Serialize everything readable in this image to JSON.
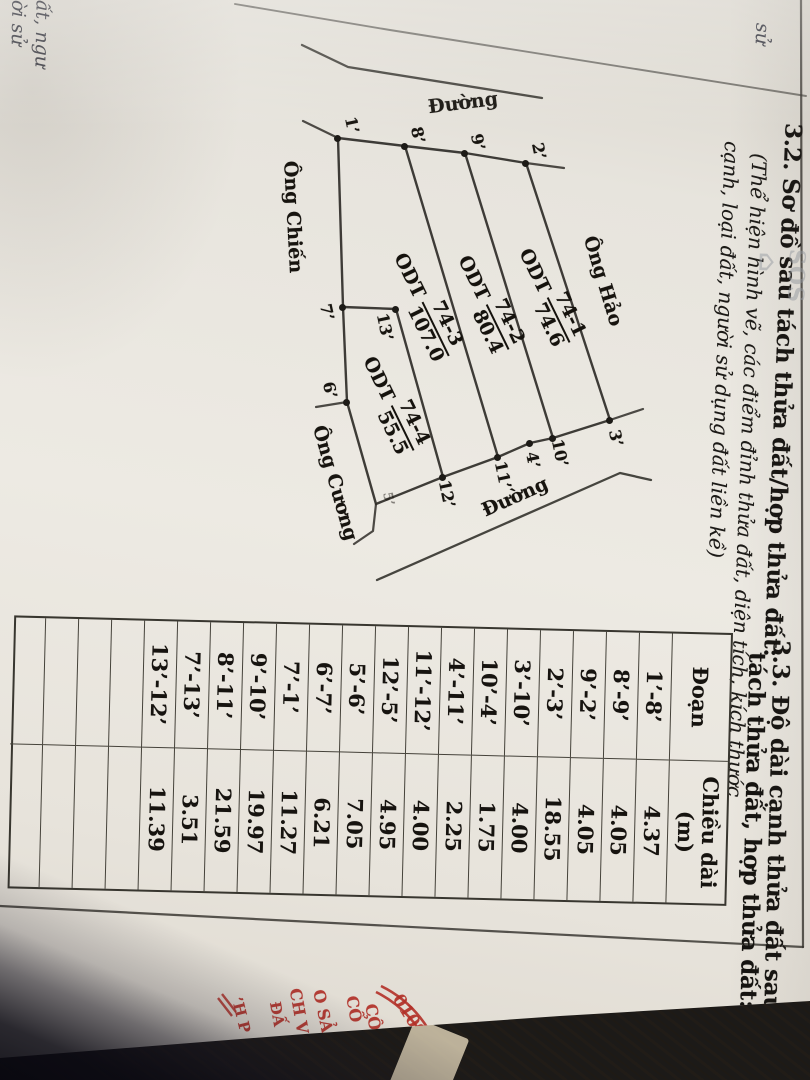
{
  "section_32": {
    "title": "3.2. Sơ đồ sau tách thửa đất/hợp thửa đất:",
    "subtitle_line1": "(Thể hiện hình vẽ, các điểm đỉnh thửa đất, diện tích, kích thước",
    "subtitle_line2": "cạnh, loại đất, người sử dụng đất liền kề)"
  },
  "section_33": {
    "title_line1": "3.3. Độ dài cạnh thửa đất sau",
    "title_line2": "tách thửa đất, hợp thửa đất:"
  },
  "table": {
    "col1_header": "Đoạn",
    "col2_header_line1": "Chiều dài",
    "col2_header_line2": "(m)",
    "rows": [
      {
        "segment": "1’-8’",
        "length": "4.37"
      },
      {
        "segment": "8’-9’",
        "length": "4.05"
      },
      {
        "segment": "9’-2’",
        "length": "4.05"
      },
      {
        "segment": "2’-3’",
        "length": "18.55"
      },
      {
        "segment": "3’-10’",
        "length": "4.00"
      },
      {
        "segment": "10’-4’",
        "length": "1.75"
      },
      {
        "segment": "4’-11’",
        "length": "2.25"
      },
      {
        "segment": "11’-12’",
        "length": "4.00"
      },
      {
        "segment": "12’-5’",
        "length": "4.95"
      },
      {
        "segment": "5’-6’",
        "length": "7.05"
      },
      {
        "segment": "6’-7’",
        "length": "6.21"
      },
      {
        "segment": "7’-1’",
        "length": "11.27"
      },
      {
        "segment": "9’-10’",
        "length": "19.97"
      },
      {
        "segment": "8’-11’",
        "length": "21.59"
      },
      {
        "segment": "7’-13’",
        "length": "3.51"
      },
      {
        "segment": "13’-12’",
        "length": "11.39"
      }
    ],
    "empty_rows": 4
  },
  "diagram": {
    "parcels": [
      {
        "land_use": "ODT",
        "id": "74-1",
        "area": "74.6",
        "x": 296,
        "y": 263,
        "rot": -26
      },
      {
        "land_use": "ODT",
        "id": "74-2",
        "area": "80.4",
        "x": 303,
        "y": 324,
        "rot": -26
      },
      {
        "land_use": "ODT",
        "id": "74-3",
        "area": "107.0",
        "x": 305,
        "y": 386,
        "rot": -26
      },
      {
        "land_use": "ODT",
        "id": "74-4",
        "area": "55.5",
        "x": 404,
        "y": 419,
        "rot": -26
      }
    ],
    "neighbors": [
      {
        "text": "Ông Hảo",
        "x": 281,
        "y": 207,
        "rot": -17
      },
      {
        "text": "Ông Chiến",
        "x": 217,
        "y": 517,
        "rot": -3
      },
      {
        "text": "Ông Cương",
        "x": 483,
        "y": 475,
        "rot": -16
      }
    ],
    "roads": [
      {
        "text": "Đường",
        "x": 103,
        "y": 347,
        "rot": -97
      },
      {
        "text": "Đường",
        "x": 497,
        "y": 295,
        "rot": -114
      }
    ],
    "points": [
      {
        "label": "1’",
        "dot": [
          138,
          472
        ],
        "lx": 125,
        "ly": 458,
        "rot": -12
      },
      {
        "label": "8’",
        "dot": [
          146,
          405
        ],
        "lx": 135,
        "ly": 392,
        "rot": -12
      },
      {
        "label": "9’",
        "dot": [
          153,
          345
        ],
        "lx": 142,
        "ly": 332,
        "rot": -12
      },
      {
        "label": "2’",
        "dot": [
          163,
          284
        ],
        "lx": 151,
        "ly": 271,
        "rot": -12
      },
      {
        "label": "3’",
        "dot": [
          420,
          200
        ],
        "lx": 438,
        "ly": 194,
        "rot": -12
      },
      {
        "label": "10’",
        "dot": [
          438,
          257
        ],
        "lx": 453,
        "ly": 250,
        "rot": -12
      },
      {
        "label": "4’",
        "dot": [
          443,
          280
        ],
        "lx": 460,
        "ly": 277,
        "rot": -12
      },
      {
        "label": "11’",
        "dot": [
          457,
          312
        ],
        "lx": 475,
        "ly": 307,
        "rot": -12
      },
      {
        "label": "12’",
        "dot": [
          477,
          367
        ],
        "lx": 494,
        "ly": 363,
        "rot": -12
      },
      {
        "label": "13’",
        "dot": [
          309,
          414
        ],
        "lx": 327,
        "ly": 425,
        "rot": -12
      },
      {
        "label": "7’",
        "dot": [
          307,
          467
        ],
        "lx": 312,
        "ly": 483,
        "rot": -12
      },
      {
        "label": "6’",
        "dot": [
          402,
          463
        ],
        "lx": 390,
        "ly": 480,
        "rot": -12
      },
      {
        "label": "5’",
        "dot": null,
        "lx": 499,
        "ly": 422,
        "rot": -12,
        "faint": true
      }
    ],
    "outline": [
      [
        138,
        472
      ],
      [
        146,
        405
      ],
      [
        153,
        345
      ],
      [
        163,
        284
      ],
      [
        420,
        200
      ],
      [
        438,
        257
      ],
      [
        443,
        280
      ],
      [
        457,
        312
      ],
      [
        477,
        367
      ],
      [
        504,
        434
      ],
      [
        402,
        463
      ],
      [
        307,
        467
      ]
    ],
    "inner_lines": [
      [
        [
          153,
          345
        ],
        [
          438,
          257
        ]
      ],
      [
        [
          146,
          405
        ],
        [
          457,
          312
        ]
      ],
      [
        [
          307,
          467
        ],
        [
          309,
          414
        ]
      ],
      [
        [
          309,
          414
        ],
        [
          477,
          367
        ]
      ]
    ],
    "extensions": [
      [
        [
          138,
          472
        ],
        [
          121,
          507
        ]
      ],
      [
        [
          163,
          284
        ],
        [
          168,
          246
        ]
      ],
      [
        [
          420,
          200
        ],
        [
          409,
          167
        ]
      ],
      [
        [
          402,
          463
        ],
        [
          407,
          494
        ]
      ],
      [
        [
          504,
          434
        ],
        [
          531,
          437
        ],
        [
          544,
          456
        ]
      ]
    ],
    "road_edges": [
      [
        [
          45,
          508
        ],
        [
          67,
          462
        ],
        [
          98,
          268
        ]
      ],
      [
        [
          480,
          159
        ],
        [
          473,
          190
        ],
        [
          580,
          433
        ]
      ]
    ],
    "frame_lines": [
      [
        [
          0,
          9
        ],
        [
          947,
          7
        ]
      ],
      [
        [
          947,
          7
        ],
        [
          906,
          810
        ]
      ]
    ],
    "cut_line": [
      [
        96,
        4
      ],
      [
        30,
        420
      ],
      [
        4,
        575
      ]
    ]
  },
  "stamp": {
    "arc_paths": [
      "M 986 429 Q 1001 398 1032 380",
      "M 992 434 Q 1007 404 1036 387"
    ],
    "slashes": [
      [
        998,
        592,
        1016,
        578
      ],
      [
        994,
        588,
        1012,
        574
      ]
    ],
    "fragments": [
      {
        "text": "0109",
        "x": 1016,
        "y": 401,
        "rot": -32,
        "size": 17
      },
      {
        "text": "CÔ",
        "x": 1017,
        "y": 437,
        "rot": -10,
        "size": 16
      },
      {
        "text": "CỔ",
        "x": 1009,
        "y": 456,
        "rot": -10,
        "size": 16
      },
      {
        "text": "O SẢ",
        "x": 1011,
        "y": 487,
        "rot": -12,
        "size": 16
      },
      {
        "text": "CH V",
        "x": 1011,
        "y": 511,
        "rot": -10,
        "size": 16
      },
      {
        "text": "ĐẤ",
        "x": 1014,
        "y": 533,
        "rot": -10,
        "size": 15
      },
      {
        "text": "’H P",
        "x": 1015,
        "y": 569,
        "rot": -14,
        "size": 15
      }
    ]
  },
  "watermark": {
    "house_glyph": "⌂",
    "text": "SOS"
  },
  "handwriting": {
    "corner_fragment": "sử",
    "edge_line1": "ất, ngư",
    "edge_line2": "ời sử"
  },
  "colors": {
    "paper": "#e9e6df",
    "ink": "#16130f",
    "line": "#2f2d28",
    "wood": "#82592a",
    "stamp_red": "#b23028",
    "shadow": "#0a0712"
  }
}
